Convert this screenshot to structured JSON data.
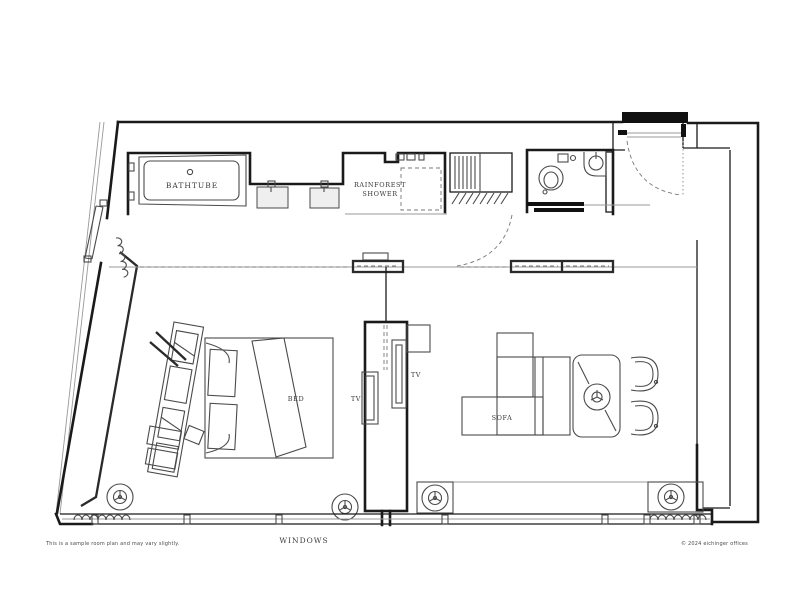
{
  "plan": {
    "labels": {
      "bathtub": "BATHTUBE",
      "shower_line1": "RAINFOREST",
      "shower_line2": "SHOWER",
      "bed": "BED",
      "tv_bed_side": "TV",
      "tv_sofa_side": "TV",
      "sofa": "SOFA",
      "windows": "WINDOWS"
    },
    "footer": {
      "disclaimer": "This is a sample room plan and may vary slightly.",
      "copyright": "© 2024 eichinger offices"
    },
    "colors": {
      "wall_line": "#1a1a1a",
      "furniture_line": "#4a4a4a",
      "light_line": "#999999",
      "label_text": "#3a3a3a",
      "background": "#ffffff"
    }
  }
}
